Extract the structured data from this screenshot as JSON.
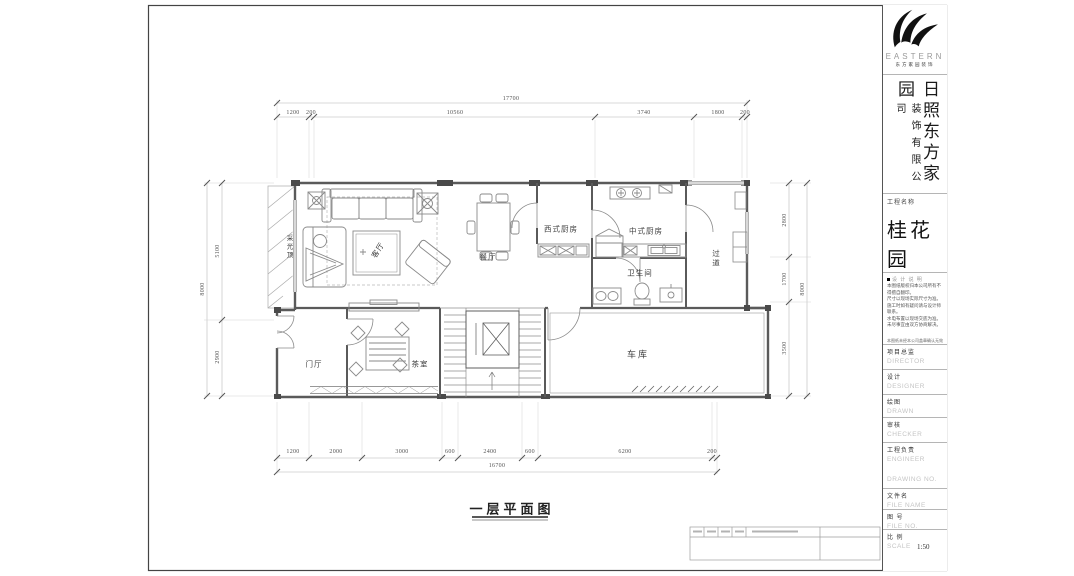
{
  "logo": {
    "brand": "EASTERN",
    "subtitle": "东方家园装饰"
  },
  "company": {
    "main": "日照东方家园",
    "sub": "装饰有限公司"
  },
  "project": {
    "label": "工程名称",
    "name": "桂花园"
  },
  "notes": {
    "header": "设 计 说 明",
    "lines": [
      "本图纸版权归本公司所有不得擅自翻印。",
      "尺寸以现场实际尺寸为准。",
      "施工时如有疑问请与设计师联系。",
      "水电布置以现场交底为准。",
      "未尽事宜由双方协商解决。"
    ],
    "footer": "本图纸未经本公司盖章确认无效"
  },
  "fields": [
    {
      "cn": "项目总监",
      "en": "DIRECTOR"
    },
    {
      "cn": "设计",
      "en": "DESIGNER"
    },
    {
      "cn": "绘图",
      "en": "DRAWN"
    },
    {
      "cn": "审核",
      "en": "CHECKER"
    },
    {
      "cn": "工程负责",
      "en": "ENGINEER"
    },
    {
      "cn": "",
      "en": "DRAWING  NO."
    },
    {
      "cn": "文件名",
      "en": "FILE  NAME"
    },
    {
      "cn": "图 号",
      "en": "FILE  NO."
    },
    {
      "cn": "比 例",
      "en": "SCALE",
      "value": "1:50"
    }
  ],
  "plan": {
    "title": "一层平面图",
    "rooms": {
      "living": "客厅",
      "dining": "餐厅",
      "west_kitchen": "西式厨房",
      "chinese_kitchen": "中式厨房",
      "bathroom": "卫生间",
      "corridor": "过道",
      "garage": "车库",
      "tea_room": "茶室",
      "foyer": "门厅",
      "skylight": "采光顶"
    },
    "dims": {
      "top_total": "17700",
      "top": [
        "1200",
        "200",
        "10560",
        "3740",
        "1800",
        "200"
      ],
      "bottom": [
        "1200",
        "2000",
        "3000",
        "600",
        "2400",
        "600",
        "6200",
        "200"
      ],
      "bottom_total": "16700",
      "left": [
        "5100",
        "2900"
      ],
      "left_total": "8000",
      "right": [
        "2800",
        "1700",
        "3500"
      ],
      "right_total": "8000"
    }
  }
}
